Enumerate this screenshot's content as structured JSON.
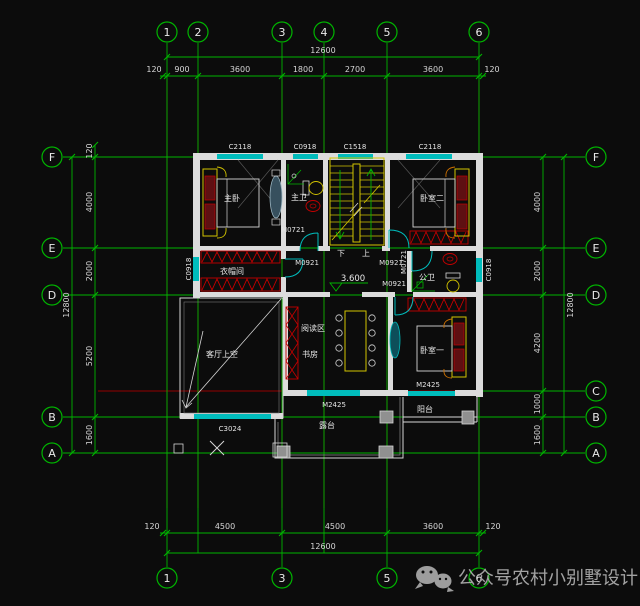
{
  "drawing": {
    "type": "floor-plan",
    "colors": {
      "background": "#0c0c0c",
      "axis_green": "#00b400",
      "centerline_red": "#950000",
      "wall_white": "#dcdcdc",
      "window_cyan": "#00bcbc",
      "fixture_yellow": "#d2c300",
      "hatch_red": "#c40000",
      "accent_orange": "#cc7000",
      "dim_text": "#d6d6d6",
      "watermark_gray": "#a2a2a2"
    }
  },
  "bubbles": {
    "top": [
      "1",
      "2",
      "3",
      "4",
      "5",
      "6"
    ],
    "bottom": [
      "1",
      "3",
      "5",
      "6"
    ],
    "left": [
      "F",
      "E",
      "D",
      "B",
      "A"
    ],
    "right": [
      "F",
      "E",
      "D",
      "C",
      "B",
      "A"
    ]
  },
  "dimensions": {
    "top": {
      "overall": "12600",
      "segments": [
        "120",
        "900",
        "3600",
        "1800",
        "2700",
        "3600",
        "120"
      ]
    },
    "bottom": {
      "overall": "12600",
      "segments": [
        "120",
        "4500",
        "4500",
        "3600",
        "120"
      ]
    },
    "left": {
      "overall": "12800",
      "edge": "120",
      "segments": [
        "4000",
        "2000",
        "5200",
        "1600"
      ]
    },
    "right": {
      "overall": "12800",
      "segments": [
        "4000",
        "2000",
        "4200",
        "1000",
        "1600"
      ]
    }
  },
  "rooms": {
    "master_bedroom": "主卧",
    "master_bath": "主卫",
    "bedroom_two": "卧室二",
    "cloakroom": "衣帽间",
    "public_bath": "公卫",
    "living_room_void": "客厅上空",
    "reading_area": "阅读区",
    "study": "书房",
    "bedroom_one": "卧室一",
    "balcony": "阳台",
    "terrace": "露台"
  },
  "openings": {
    "c2118": "C2118",
    "c0918": "C0918",
    "c1518": "C1518",
    "c3024": "C3024",
    "m0721": "M0721",
    "m0921": "M0921",
    "m2425": "M2425"
  },
  "annotations": {
    "level": "3.600",
    "down": "下",
    "up": "上"
  },
  "watermark": {
    "icon": "wechat-icon",
    "brand": "公众号",
    "dot": "·",
    "name": "农村小别墅设计"
  }
}
